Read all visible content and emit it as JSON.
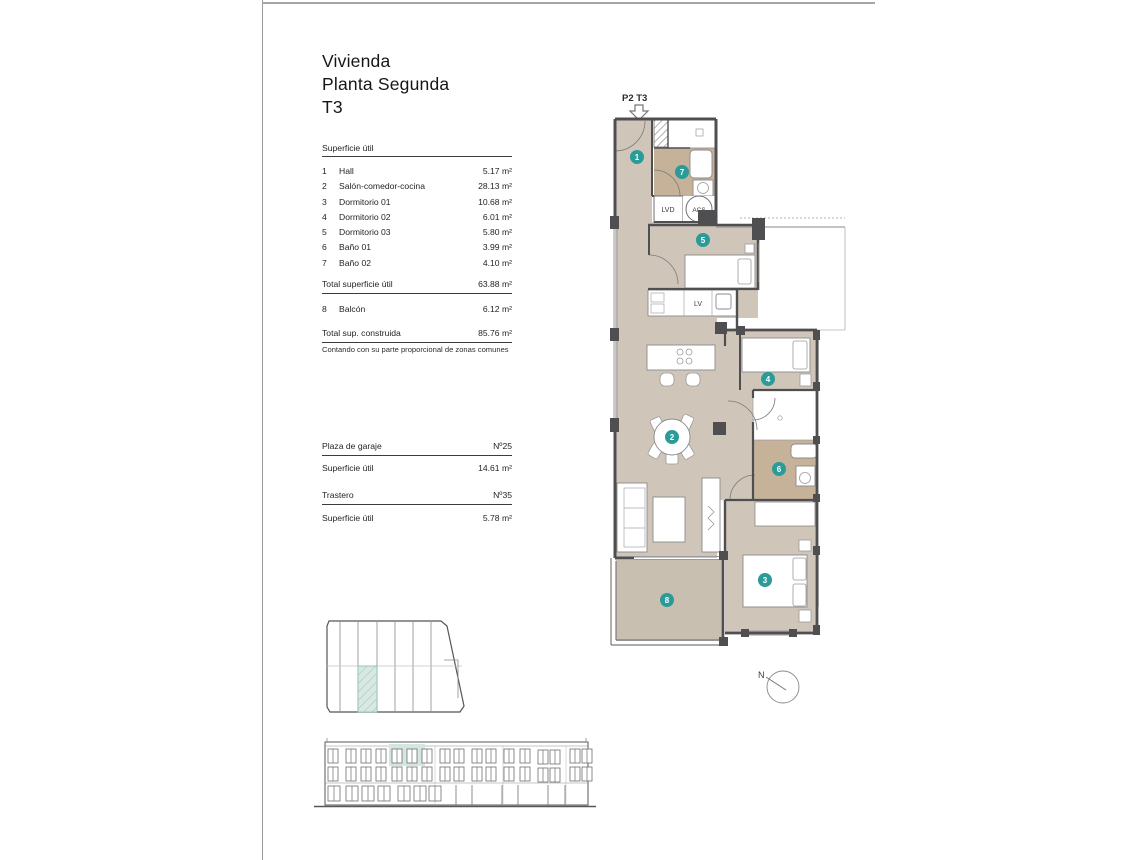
{
  "title": {
    "line1": "Vivienda",
    "line2": "Planta Segunda",
    "line3": "T3"
  },
  "surface_table": {
    "header": "Superficie útil",
    "rows": [
      {
        "num": "1",
        "label": "Hall",
        "value": "5.17 m²"
      },
      {
        "num": "2",
        "label": "Salón-comedor-cocina",
        "value": "28.13 m²"
      },
      {
        "num": "3",
        "label": "Dormitorio 01",
        "value": "10.68 m²"
      },
      {
        "num": "4",
        "label": "Dormitorio 02",
        "value": "6.01 m²"
      },
      {
        "num": "5",
        "label": "Dormitorio 03",
        "value": "5.80 m²"
      },
      {
        "num": "6",
        "label": "Baño 01",
        "value": "3.99 m²"
      },
      {
        "num": "7",
        "label": "Baño 02",
        "value": "4.10 m²"
      }
    ],
    "total_util": {
      "label": "Total superficie útil",
      "value": "63.88 m²"
    },
    "balcony_row": {
      "num": "8",
      "label": "Balcón",
      "value": "6.12 m²"
    },
    "total_built": {
      "label": "Total sup. construida",
      "value": "85.76 m²"
    },
    "footnote": "Contando con su parte proporcional de zonas comunes"
  },
  "garage": {
    "plaza_label": "Plaza de garaje",
    "plaza_number": "Nº25",
    "plaza_area_label": "Superficie útil",
    "plaza_area_value": "14.61 m²",
    "trastero_label": "Trastero",
    "trastero_number": "Nº35",
    "trastero_area_label": "Superficie útil",
    "trastero_area_value": "5.78 m²"
  },
  "plan": {
    "unit_label": "P2 T3",
    "room_badges": [
      "1",
      "2",
      "3",
      "4",
      "5",
      "6",
      "7",
      "8"
    ],
    "labels": {
      "lvd": "LVD",
      "acs": "ACS",
      "lv": "LV",
      "north": "N"
    },
    "colors": {
      "badge": "#2b9b99",
      "floor": "#cfc6b9",
      "bath_floor": "#c6b199",
      "balcony_floor": "#c8bfb1",
      "wall": "#4f4f51",
      "highlight": "#d8e8e3"
    }
  }
}
